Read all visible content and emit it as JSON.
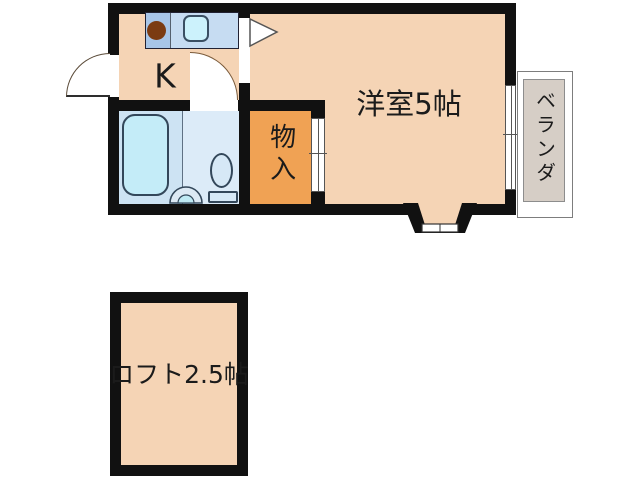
{
  "floorplan": {
    "type": "japanese-apartment-1K-with-loft",
    "rooms": {
      "kitchen": {
        "label": "K"
      },
      "main_room": {
        "label": "洋室5帖"
      },
      "closet": {
        "label": "物入"
      },
      "veranda": {
        "label": "ベランダ"
      },
      "loft": {
        "label": "ロフト2.5帖"
      }
    },
    "fixtures": [
      "kitchen-counter",
      "stove-burner",
      "kitchen-sink",
      "bathtub",
      "toilet",
      "wash-basin",
      "entrance-door",
      "kitchen-door",
      "closet-door",
      "window-to-veranda",
      "bay-window"
    ],
    "colors": {
      "wall": "#111111",
      "floor_peach": "#f5d4b5",
      "closet_orange": "#f0a254",
      "bathroom_blue": "#cde3f3",
      "bathroom_blue_light": "#dcebf8",
      "fixture_cyan": "#c4ecf8",
      "counter_blue": "#a8c6e8",
      "veranda_gray": "#d6cec6",
      "background": "#ffffff",
      "text": "#1b1b1b"
    }
  }
}
